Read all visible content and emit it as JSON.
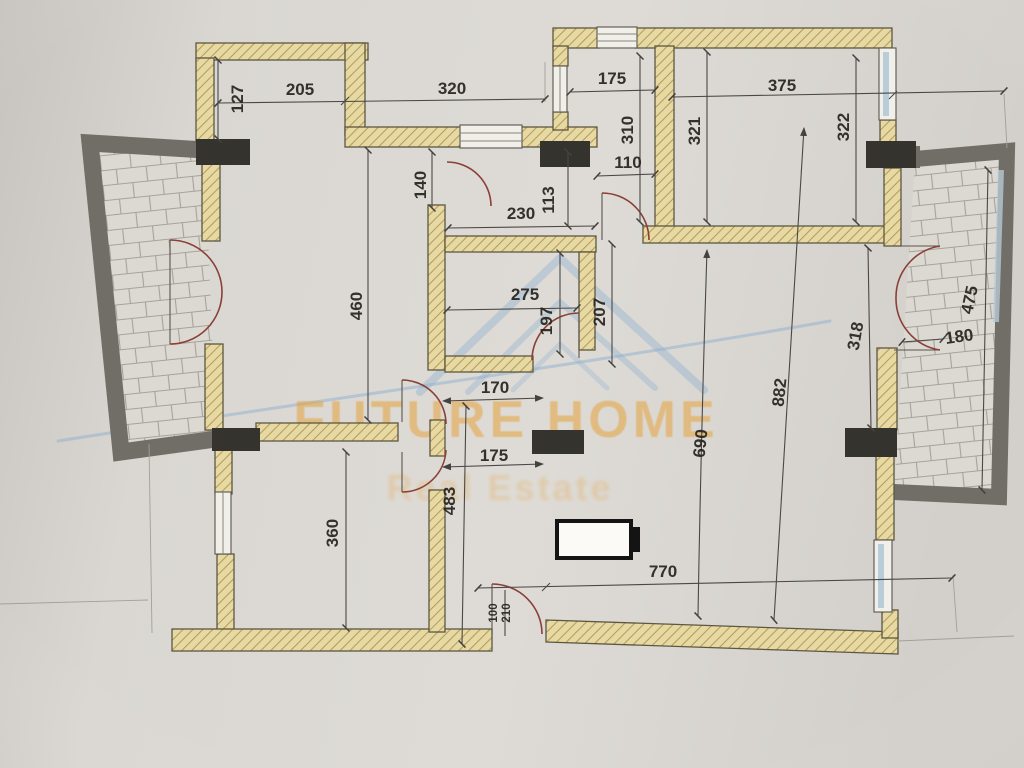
{
  "document": {
    "kind": "scanned apartment floor plan photo",
    "brand_watermark": "FUTURE HOME",
    "brand_tagline": "Real Estate"
  },
  "dims": {
    "d127": "127",
    "d205": "205",
    "d320": "320",
    "d175_top": "175",
    "d310": "310",
    "d110": "110",
    "d140": "140",
    "d230": "230",
    "d113": "113",
    "d375": "375",
    "d321": "321",
    "d322": "322",
    "d460": "460",
    "d275": "275",
    "d197": "197",
    "d207": "207",
    "d170": "170",
    "d175_mid": "175",
    "d483": "483",
    "d360": "360",
    "d690": "690",
    "d882": "882",
    "d318": "318",
    "d180": "180",
    "d475": "475",
    "d770": "770",
    "door_width": "100",
    "door_height": "210"
  },
  "colors": {
    "paper": "#d9d6d1",
    "wall_fill": "#e7d9a4",
    "wall_hatch": "#b59c58",
    "wall_outline": "#5d5741",
    "column": "#35332e",
    "balcony_border": "#716e68",
    "tile_line": "#a7a39b",
    "dimension": "#4a4846",
    "door_arc": "#8a4038",
    "window_glass": "#b8cdd8",
    "watermark_orange": "#e5a33c",
    "watermark_blue": "#8fb0d0"
  }
}
